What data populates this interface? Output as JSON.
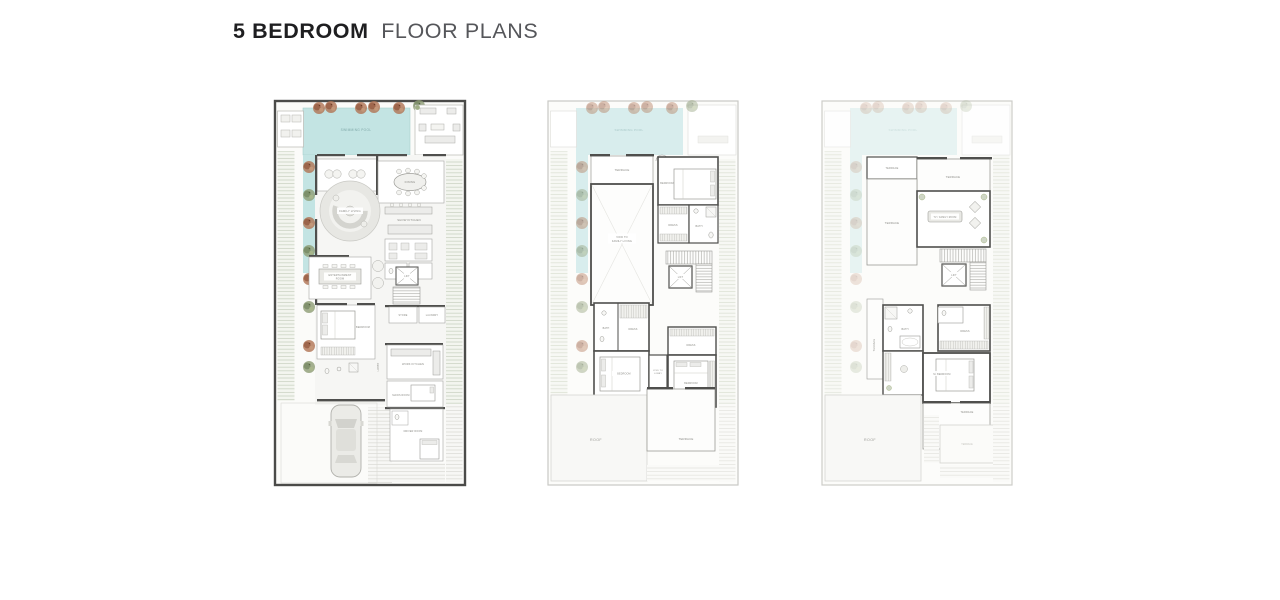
{
  "header": {
    "title_bold": "5 BEDROOM",
    "title_light": "FLOOR PLANS"
  },
  "colors": {
    "title_dark": "#1e1e20",
    "title_light": "#55565a",
    "wall": "#4f4f4d",
    "ghost_line": "#cfcfcb",
    "pool_ground": "#c3e4e3",
    "pool_first": "#d8eded",
    "pool_second": "#e3f2f1",
    "tree_rust": "#b07352",
    "tree_green": "#8d9c74",
    "garden_hatch": "#ccd4c4",
    "paving_hatch": "#dcdcd8",
    "label": "#8b8b86"
  },
  "plans": [
    {
      "id": "ground-floor",
      "labels": {
        "swimming_pool": "SWIMMING POOL",
        "dining": "DINING",
        "show_kitchen": "SHOW KITCHEN",
        "family_living": "FAMILY LIVING",
        "entertainment_1": "ENTERTAINMENT",
        "entertainment_2": "ROOM",
        "bedroom": "BEDROOM",
        "store": "STORE",
        "laundry": "LAUNDRY",
        "lift": "LIFT",
        "lobby": "LOBBY",
        "work_kitchen": "WORK KITCHEN",
        "maids_room": "MAIDS ROOM",
        "driver_room": "DRIVER ROOM"
      }
    },
    {
      "id": "first-floor",
      "labels": {
        "swimming_pool": "SWIMMING POOL",
        "terrace_top": "TERRACE",
        "void_1": "VOID TO",
        "void_2": "FAMILY LIVING",
        "bedroom_top": "BEDROOM",
        "dress_top": "DRESS",
        "bath_top": "BATH",
        "lift": "LIFT",
        "bath_mid": "BATH",
        "dress_mid": "DRESS",
        "bedroom_left": "BEDROOM",
        "voidlobby_1": "VOID TO",
        "voidlobby_2": "LOBBY",
        "dress_right": "DRESS",
        "bedroom_right": "BEDROOM",
        "roof": "ROOF",
        "terrace_bottom": "TERRACE"
      }
    },
    {
      "id": "second-floor",
      "labels": {
        "swimming_pool": "SWIMMING POOL",
        "terrace_upper": "TERRACE",
        "terrace_top_right": "TERRACE",
        "terrace_left": "TERRACE",
        "tv_room": "TV / FAMILY ROOM",
        "lift": "LIFT",
        "bath": "BATH",
        "dress": "DRESS",
        "terrace_side": "TERRACE",
        "m_bedroom": "M. BEDROOM",
        "terrace_bottom": "TERRACE",
        "terrace_ghost": "TERRACE",
        "roof": "ROOF"
      }
    }
  ]
}
